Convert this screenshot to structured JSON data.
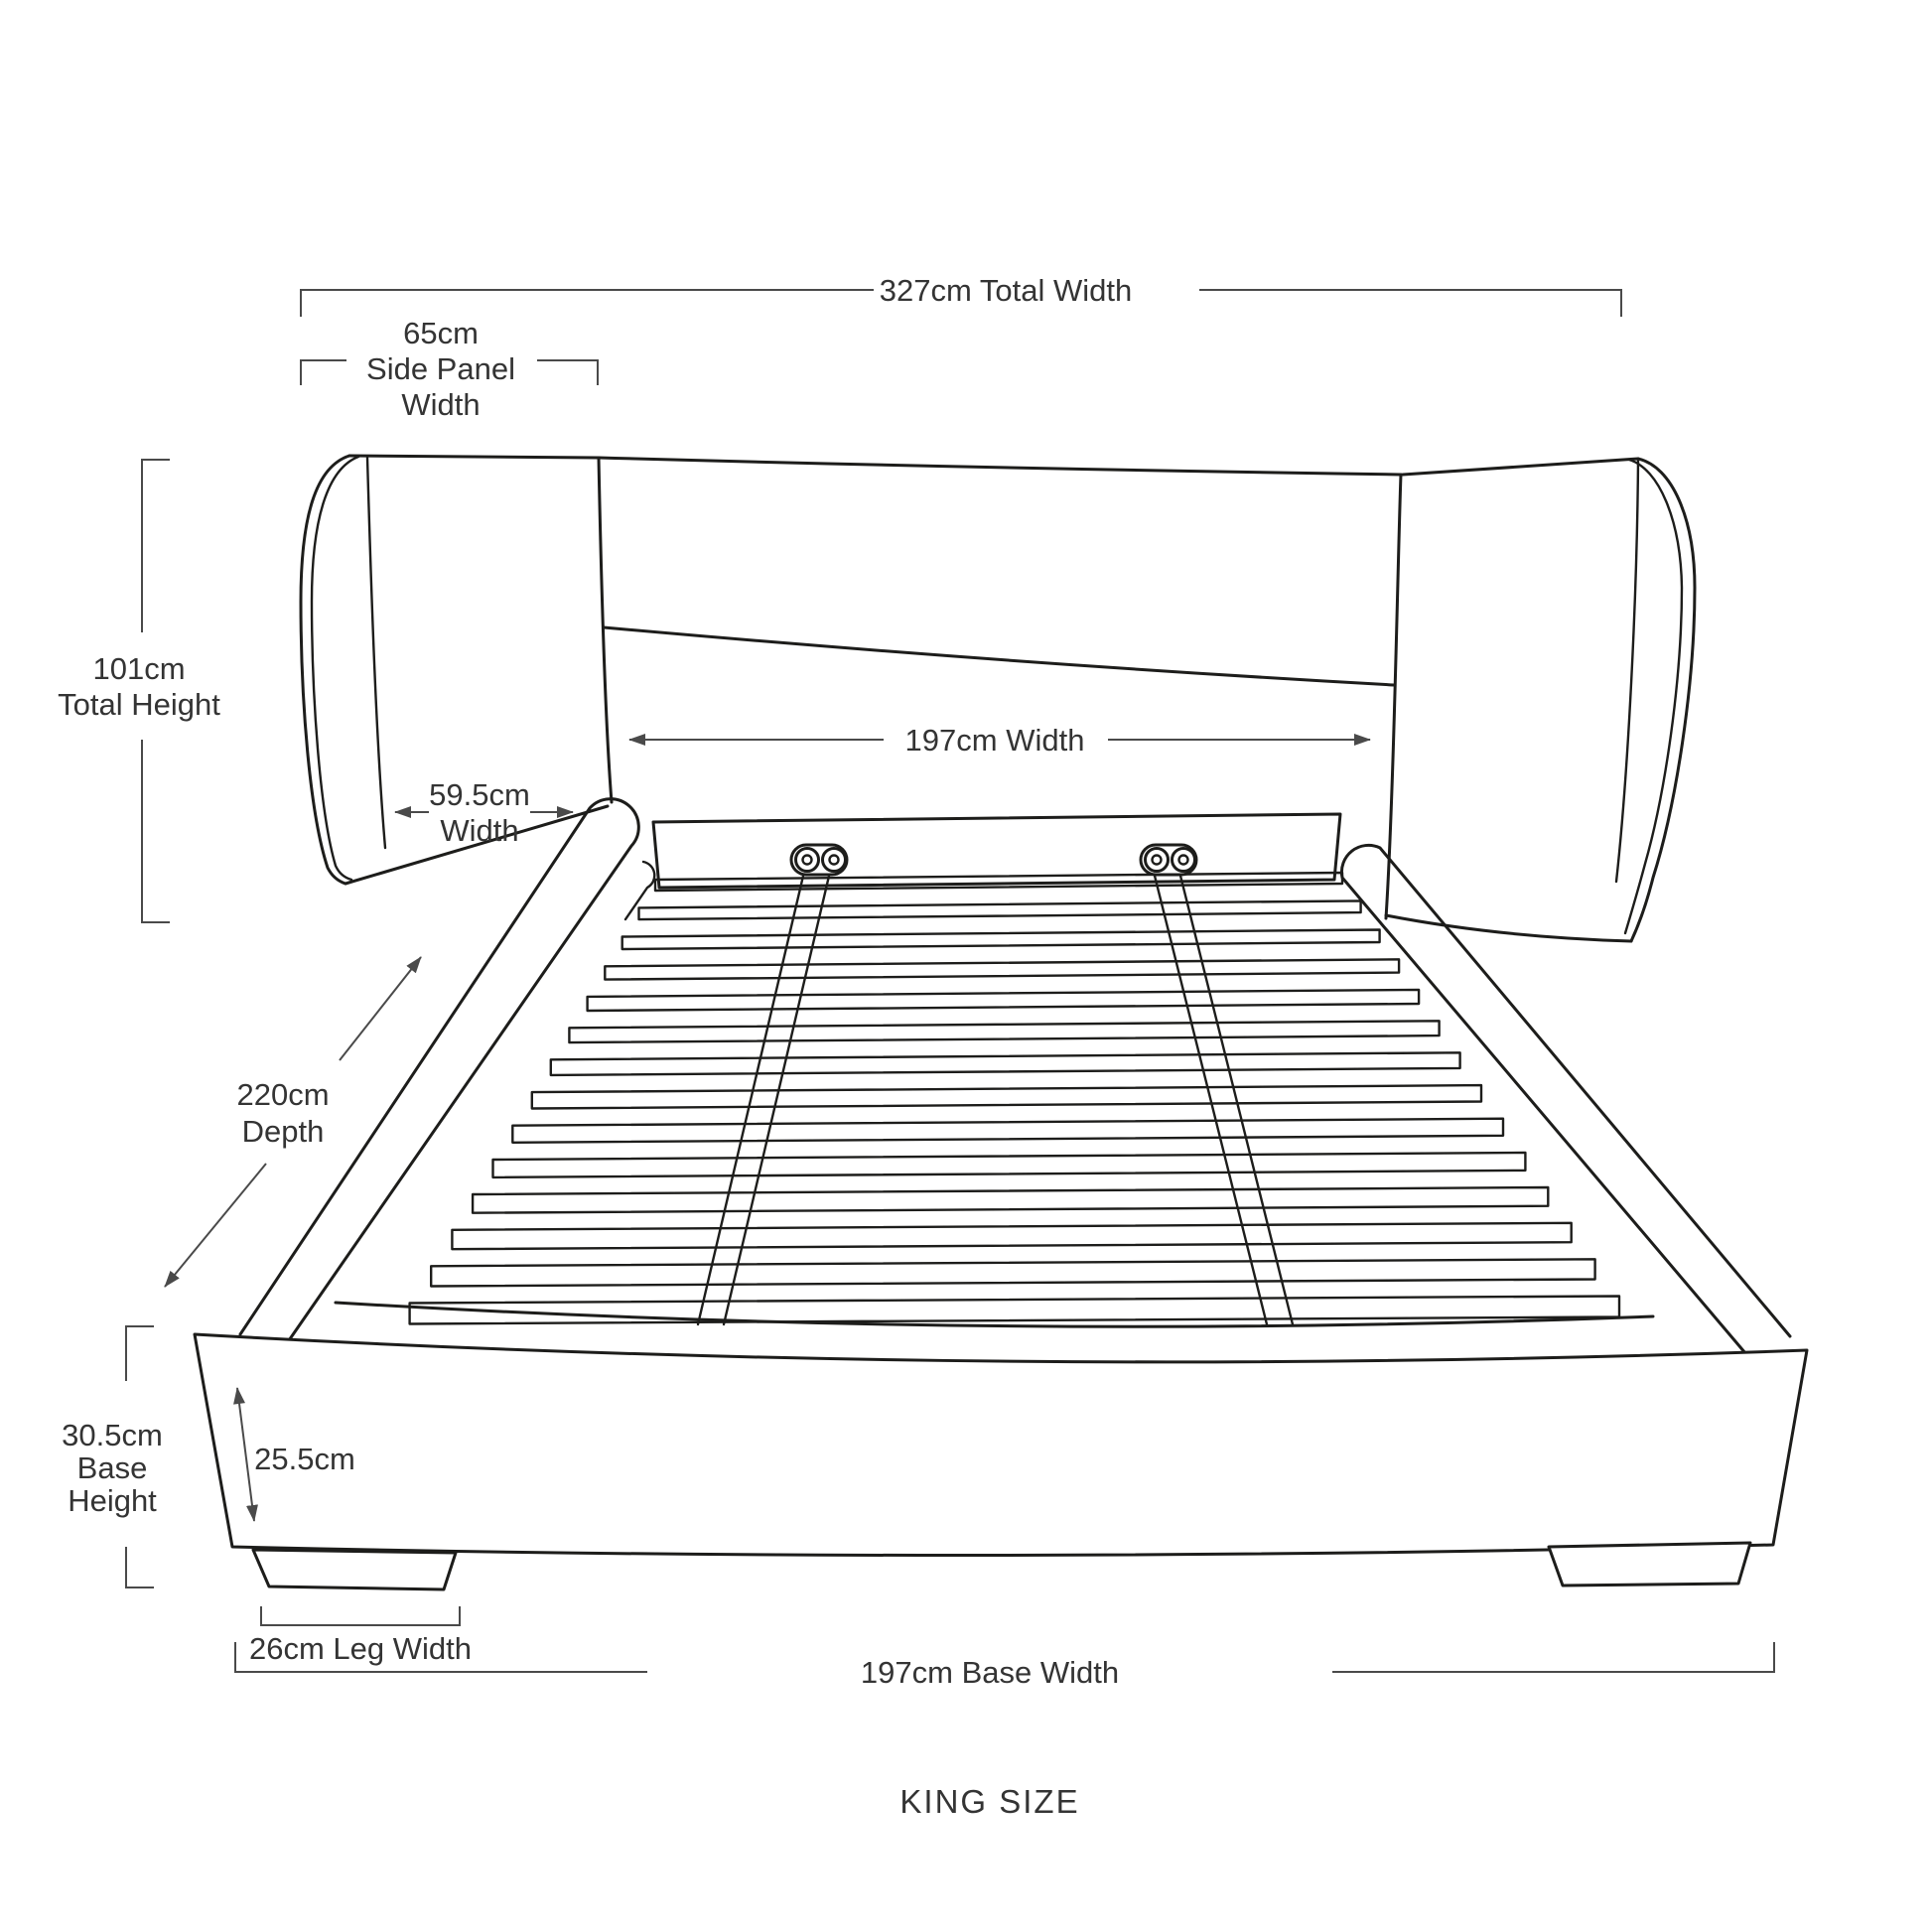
{
  "diagram": {
    "product": "upholstered bed frame with winged headboard, slatted base and legs",
    "size_label": "KING SIZE",
    "labels": {
      "total_width": "327cm Total Width",
      "side_panel": [
        "65cm",
        "Side Panel",
        "Width"
      ],
      "total_height": [
        "101cm",
        "Total Height"
      ],
      "headboard_width": "197cm Width",
      "inner_panel": [
        "59.5cm",
        "Width"
      ],
      "depth": [
        "220cm",
        "Depth"
      ],
      "base_height": [
        "30.5cm",
        "Base",
        "Height"
      ],
      "base_front_height": "25.5cm",
      "leg_width": "26cm Leg Width",
      "base_width": "197cm Base Width"
    },
    "measurements": {
      "total_width_cm": 327,
      "side_panel_width_cm": 65,
      "total_height_cm": 101,
      "headboard_width_cm": 197,
      "inner_panel_width_cm": 59.5,
      "depth_cm": 220,
      "base_height_cm": 30.5,
      "base_front_height_cm": 25.5,
      "leg_width_cm": 26,
      "base_width_cm": 197
    },
    "colors": {
      "background": "#ffffff",
      "outline": "#1d1d1b",
      "dimension_lines": "#4a4a4a",
      "text": "#343434"
    }
  }
}
